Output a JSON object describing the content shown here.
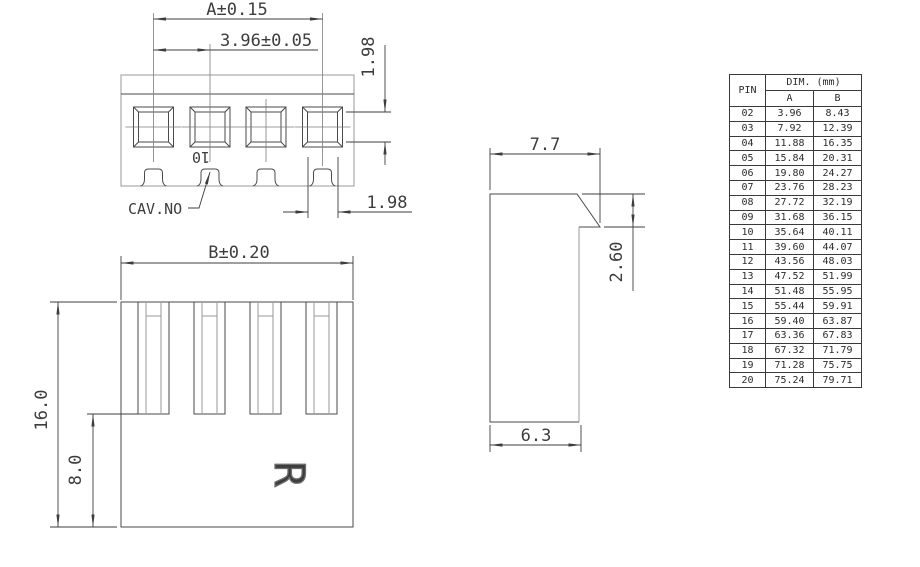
{
  "front_view": {
    "dim_overall": "A±0.15",
    "dim_pitch": "3.96±0.05",
    "dim_cavity_height": "1.98",
    "dim_cavity_width": "1.98",
    "cav_no_label": "CAV.NO",
    "cavity_marking": "10"
  },
  "side_view": {
    "dim_top_width": "7.7",
    "dim_latch_height": "2.60",
    "dim_body_width": "6.3"
  },
  "bottom_view": {
    "dim_overall": "B±0.20",
    "dim_height": "16.0",
    "dim_slot_depth": "8.0",
    "logo_mark": "R"
  },
  "dim_table": {
    "header_pin": "PIN",
    "header_dim": "DIM. (mm)",
    "header_a": "A",
    "header_b": "B",
    "rows": [
      [
        "02",
        "3.96",
        "8.43"
      ],
      [
        "03",
        "7.92",
        "12.39"
      ],
      [
        "04",
        "11.88",
        "16.35"
      ],
      [
        "05",
        "15.84",
        "20.31"
      ],
      [
        "06",
        "19.80",
        "24.27"
      ],
      [
        "07",
        "23.76",
        "28.23"
      ],
      [
        "08",
        "27.72",
        "32.19"
      ],
      [
        "09",
        "31.68",
        "36.15"
      ],
      [
        "10",
        "35.64",
        "40.11"
      ],
      [
        "11",
        "39.60",
        "44.07"
      ],
      [
        "12",
        "43.56",
        "48.03"
      ],
      [
        "13",
        "47.52",
        "51.99"
      ],
      [
        "14",
        "51.48",
        "55.95"
      ],
      [
        "15",
        "55.44",
        "59.91"
      ],
      [
        "16",
        "59.40",
        "63.87"
      ],
      [
        "17",
        "63.36",
        "67.83"
      ],
      [
        "18",
        "67.32",
        "71.79"
      ],
      [
        "19",
        "71.28",
        "75.75"
      ],
      [
        "20",
        "75.24",
        "79.71"
      ]
    ]
  }
}
